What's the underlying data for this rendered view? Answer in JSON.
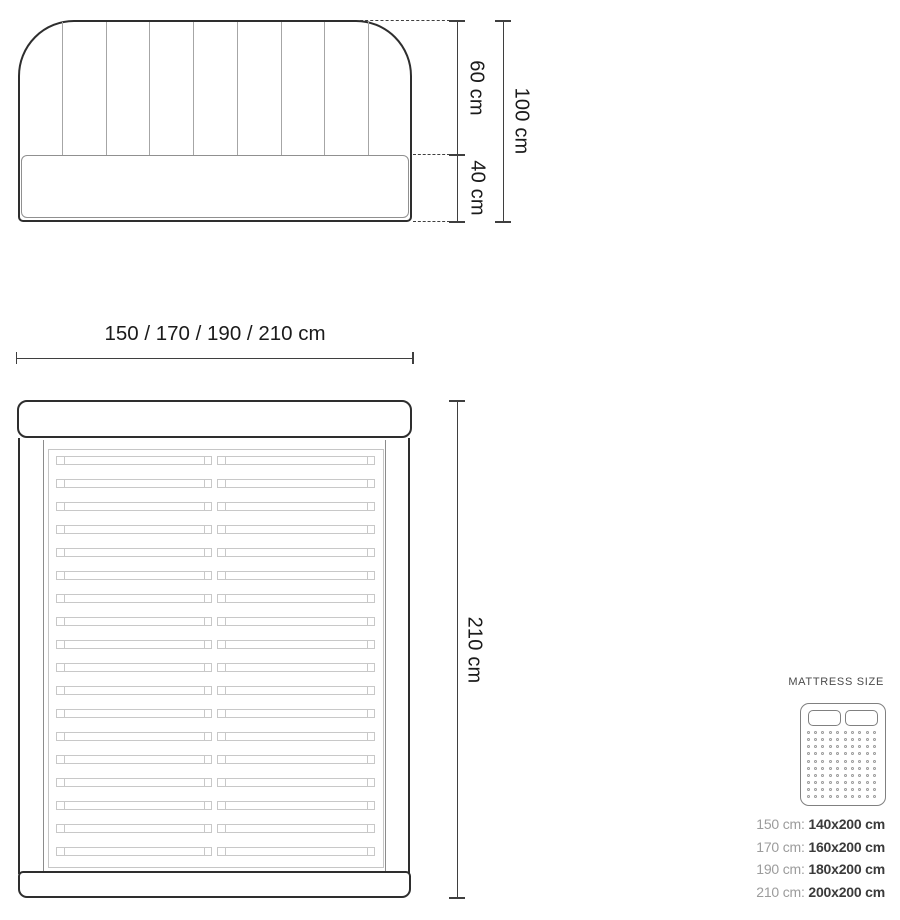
{
  "front_view": {
    "height_upper_label": "60 cm",
    "height_lower_label": "40 cm",
    "height_total_label": "100 cm"
  },
  "top_view": {
    "width_options_label": "150 / 170 / 190 / 210 cm",
    "length_label": "210 cm"
  },
  "mattress_panel": {
    "title": "MATTRESS SIZE",
    "rows": [
      {
        "label": "150 cm:",
        "value": "140x200 cm"
      },
      {
        "label": "170 cm:",
        "value": "160x200 cm"
      },
      {
        "label": "190 cm:",
        "value": "180x200 cm"
      },
      {
        "label": "210 cm:",
        "value": "200x200 cm"
      }
    ]
  },
  "diagram": {
    "headboard_channel_lines": 8,
    "slat_rows": 18,
    "dot_rows": 10,
    "dot_cols": 10
  },
  "colors": {
    "outline": "#2e2e2e",
    "mid_gray": "#8c8c8c",
    "light_gray": "#c8c8c8",
    "dimension": "#3f3f3f",
    "table_label_gray": "#9c9c9c",
    "table_value_dark": "#3a3a3a"
  }
}
